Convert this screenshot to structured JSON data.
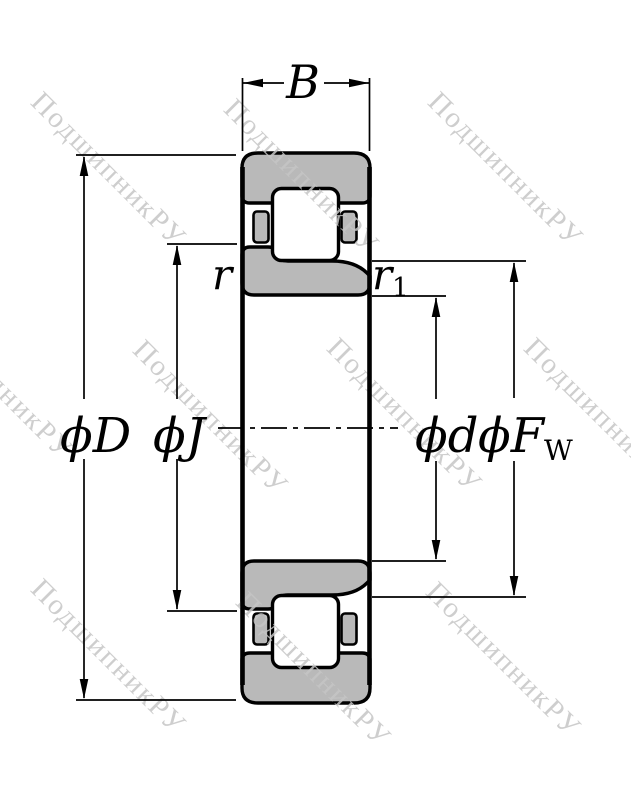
{
  "figure": {
    "type": "bearing-cross-section-drawing"
  },
  "labels": {
    "width": "B",
    "outer_diameter": "ϕD",
    "flange_diameter": "ϕJ",
    "bore_diameter": "ϕd",
    "raceway_diameter_main": "ϕF",
    "raceway_diameter_sub": "W",
    "chamfer_left": "r",
    "chamfer_right_main": "r",
    "chamfer_right_sub": "1"
  },
  "watermark": {
    "text": "ПодшипникРУ",
    "color": "#c6c6c6",
    "instances": [
      [
        45,
        88
      ],
      [
        238,
        95
      ],
      [
        442,
        88
      ],
      [
        -68,
        300
      ],
      [
        147,
        336
      ],
      [
        341,
        334
      ],
      [
        538,
        334
      ],
      [
        45,
        575
      ],
      [
        250,
        588
      ],
      [
        440,
        578
      ]
    ]
  },
  "colors": {
    "ring_fill": "#b9b9b9",
    "line": "#000000",
    "background": "#ffffff"
  }
}
